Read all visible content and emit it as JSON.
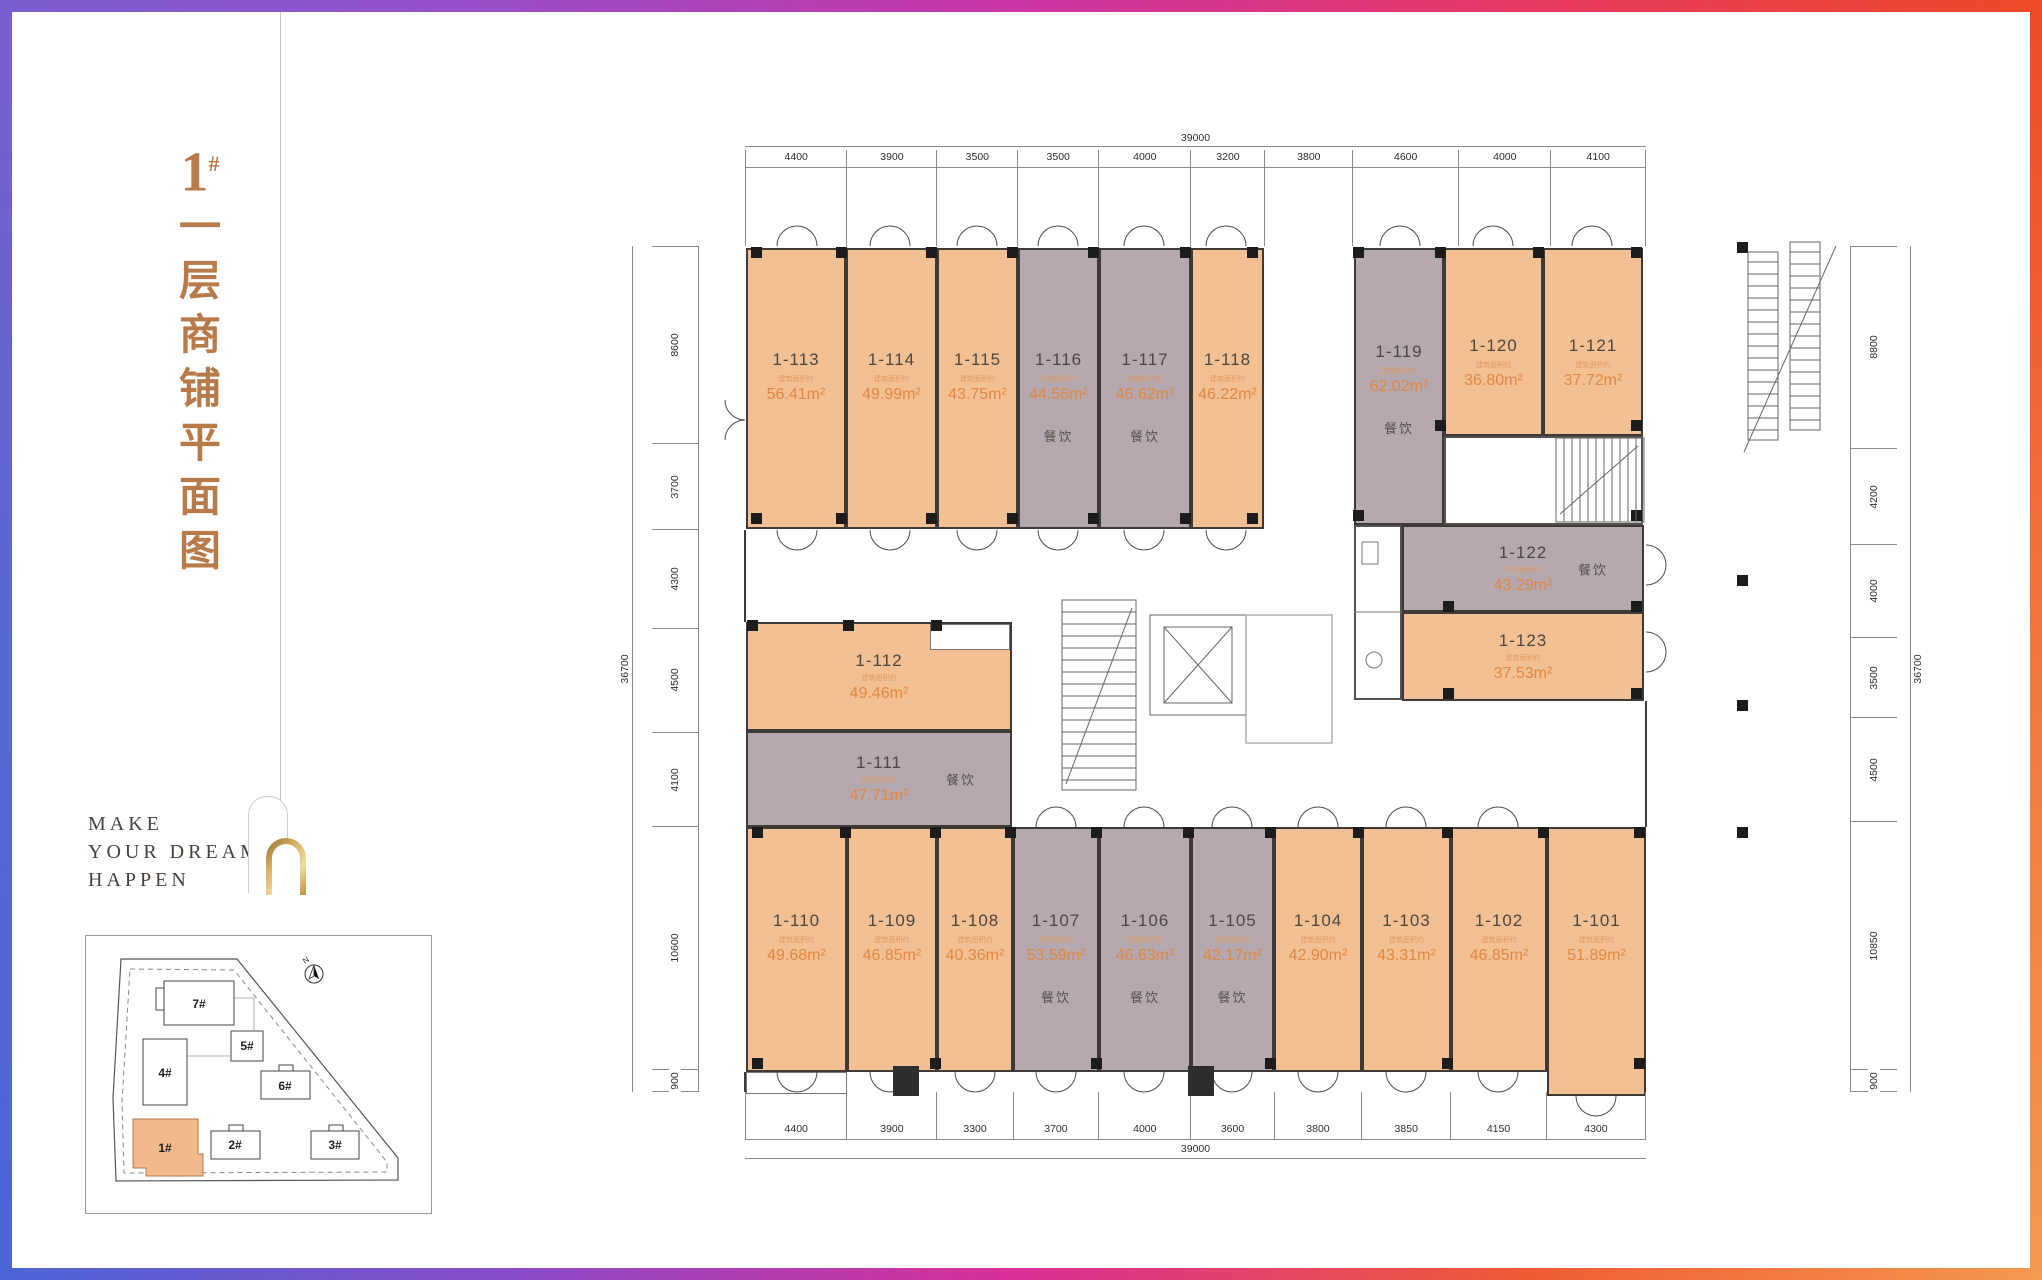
{
  "page": {
    "building_no": "1",
    "building_no_sup": "#",
    "title_chars": [
      "一",
      "层",
      "商",
      "铺",
      "平",
      "面",
      "图"
    ],
    "slogan": [
      "MAKE",
      "YOUR DREAMS",
      "HAPPEN"
    ]
  },
  "labels": {
    "area_note": "建筑面积约",
    "food": "餐饮"
  },
  "site_map": {
    "north": "N",
    "buildings": [
      "7#",
      "5#",
      "4#",
      "6#",
      "1#",
      "2#",
      "3#"
    ],
    "highlight_color": "#f0ba8d"
  },
  "colors": {
    "shop": "#f2c093",
    "food_shop": "#b5a8af",
    "accent": "#e2873f",
    "title": "#b97a4a"
  },
  "dims": {
    "top": {
      "total": "39000",
      "segments": [
        "4400",
        "3900",
        "3500",
        "3500",
        "4000",
        "3200",
        "3800",
        "4600",
        "4000",
        "4100"
      ]
    },
    "bottom": {
      "total": "39000",
      "segments": [
        "4400",
        "3900",
        "3300",
        "3700",
        "4000",
        "3600",
        "3800",
        "3850",
        "4150",
        "4300"
      ]
    },
    "left": {
      "total": "36700",
      "segments": [
        "8600",
        "3700",
        "4300",
        "4500",
        "4100",
        "10600",
        "900"
      ]
    },
    "right": {
      "total": "36700",
      "segments": [
        "8800",
        "4200",
        "4000",
        "3500",
        "4500",
        "10850",
        "900"
      ]
    }
  },
  "units": [
    {
      "id": "1-113",
      "area": "56.41m²"
    },
    {
      "id": "1-114",
      "area": "49.99m²"
    },
    {
      "id": "1-115",
      "area": "43.75m²"
    },
    {
      "id": "1-116",
      "area": "44.56m²",
      "use": "餐饮"
    },
    {
      "id": "1-117",
      "area": "46.62m²",
      "use": "餐饮"
    },
    {
      "id": "1-118",
      "area": "46.22m²"
    },
    {
      "id": "1-119",
      "area": "62.02m²",
      "use": "餐饮"
    },
    {
      "id": "1-120",
      "area": "36.80m²"
    },
    {
      "id": "1-121",
      "area": "37.72m²"
    },
    {
      "id": "1-122",
      "area": "43.29m²",
      "use": "餐饮"
    },
    {
      "id": "1-123",
      "area": "37.53m²"
    },
    {
      "id": "1-112",
      "area": "49.46m²"
    },
    {
      "id": "1-111",
      "area": "47.71m²",
      "use": "餐饮"
    },
    {
      "id": "1-110",
      "area": "49.68m²"
    },
    {
      "id": "1-109",
      "area": "46.85m²"
    },
    {
      "id": "1-108",
      "area": "40.36m²"
    },
    {
      "id": "1-107",
      "area": "53.59m²",
      "use": "餐饮"
    },
    {
      "id": "1-106",
      "area": "46.63m²",
      "use": "餐饮"
    },
    {
      "id": "1-105",
      "area": "42.17m²",
      "use": "餐饮"
    },
    {
      "id": "1-104",
      "area": "42.90m²"
    },
    {
      "id": "1-103",
      "area": "43.31m²"
    },
    {
      "id": "1-102",
      "area": "46.85m²"
    },
    {
      "id": "1-101",
      "area": "51.89m²"
    }
  ]
}
